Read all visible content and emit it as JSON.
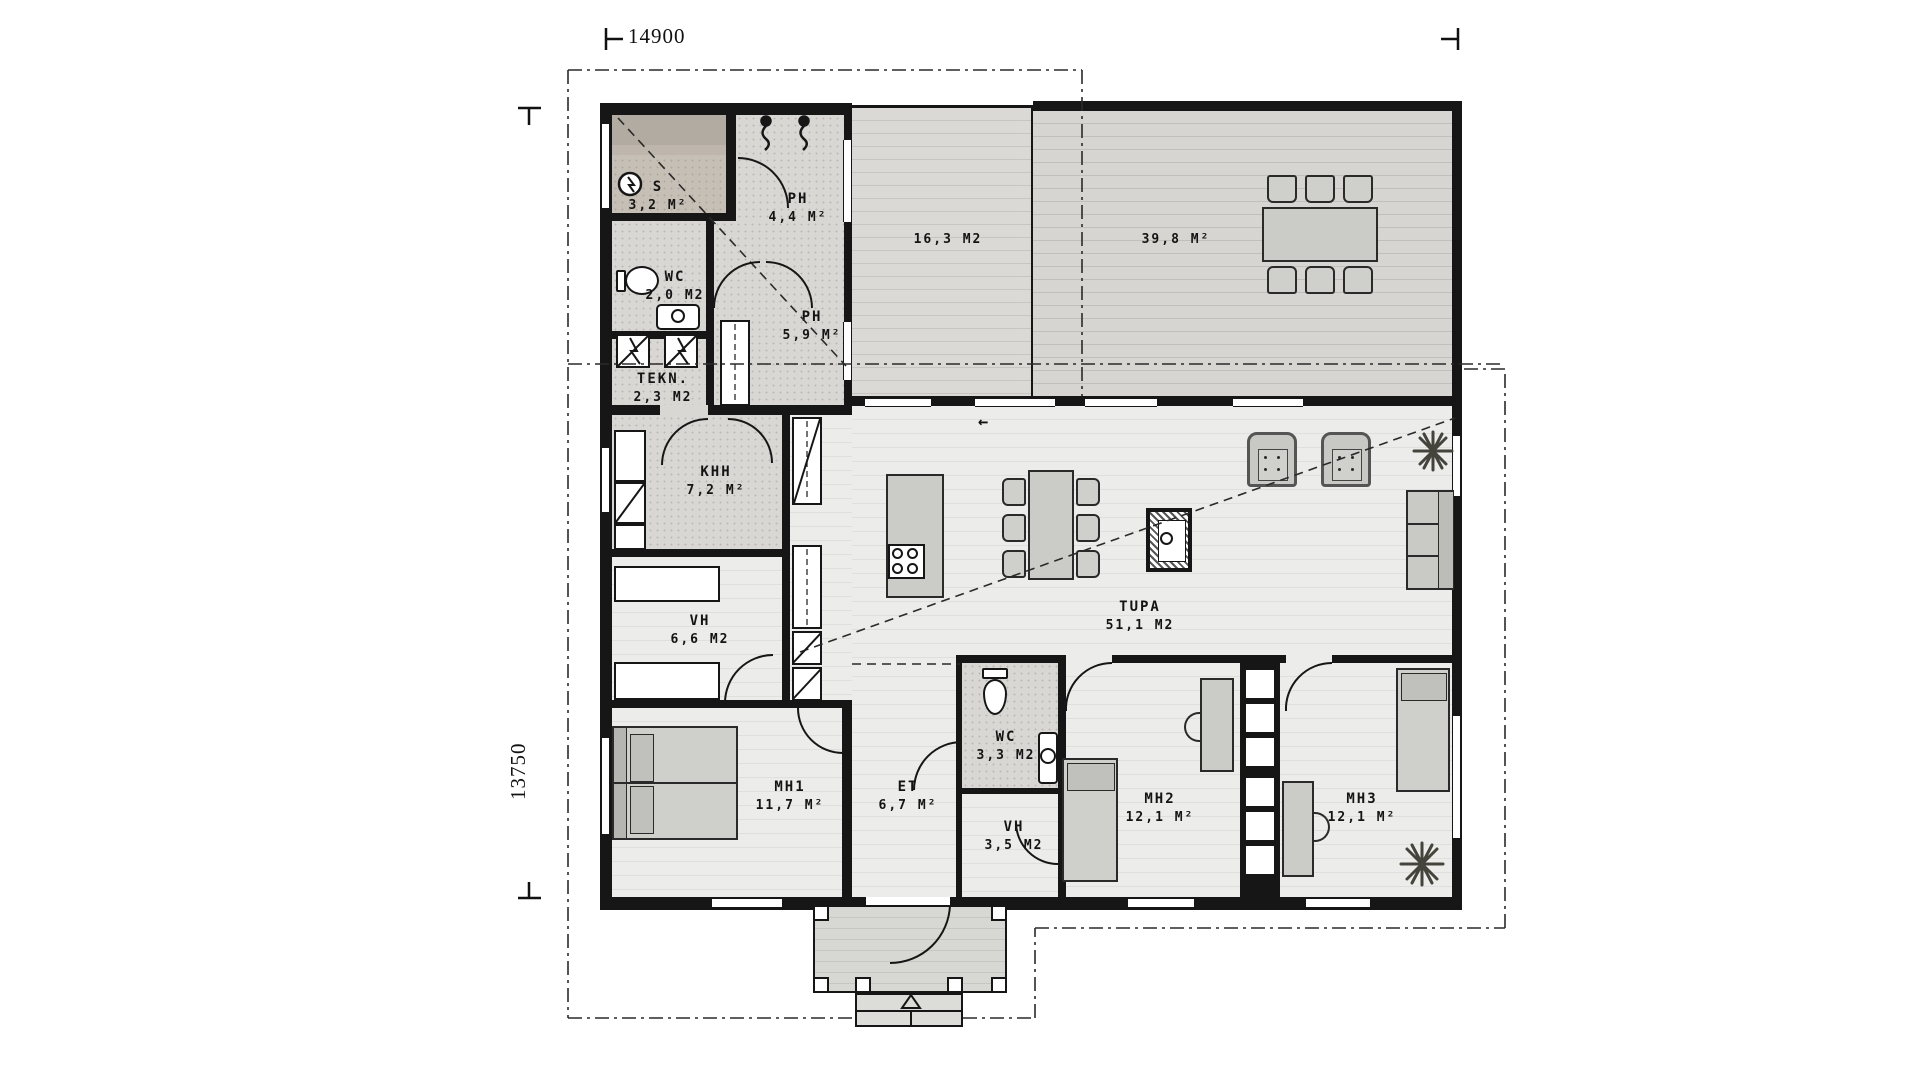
{
  "plan": {
    "title": "single-storey house floor plan",
    "dimensions": {
      "width_label": "14900",
      "height_label": "13750"
    },
    "rooms": [
      {
        "name": "S",
        "area": "3,2 M²"
      },
      {
        "name": "PH",
        "area": "4,4 M²"
      },
      {
        "name": "WC",
        "area": "2,0 M2"
      },
      {
        "name": "PH",
        "area": "5,9 M²"
      },
      {
        "name": "TEKN.",
        "area": "2,3 M2"
      },
      {
        "name": "KHH",
        "area": "7,2 M²"
      },
      {
        "name": "VH",
        "area": "6,6 M2"
      },
      {
        "name": "MH1",
        "area": "11,7 M²"
      },
      {
        "name": "ET",
        "area": "6,7 M²"
      },
      {
        "name": "WC",
        "area": "3,3 M2"
      },
      {
        "name": "VH",
        "area": "3,5 M2"
      },
      {
        "name": "MH2",
        "area": "12,1 M²"
      },
      {
        "name": "MH3",
        "area": "12,1 M²"
      },
      {
        "name": "TUPA",
        "area": "51,1 M2"
      }
    ],
    "terraces": [
      {
        "area": "16,3 M2"
      },
      {
        "area": "39,8 M²"
      }
    ],
    "icons": {
      "slide_arrow": "←"
    },
    "colors": {
      "wall": "#161616",
      "floor": "#ececea",
      "wet_floor": "#d8d7d4",
      "sauna_floor": "#c6bfb6",
      "terrace_floor": "#dad9d6",
      "furniture": "#cbcbc8",
      "plant": "#44443c"
    }
  }
}
